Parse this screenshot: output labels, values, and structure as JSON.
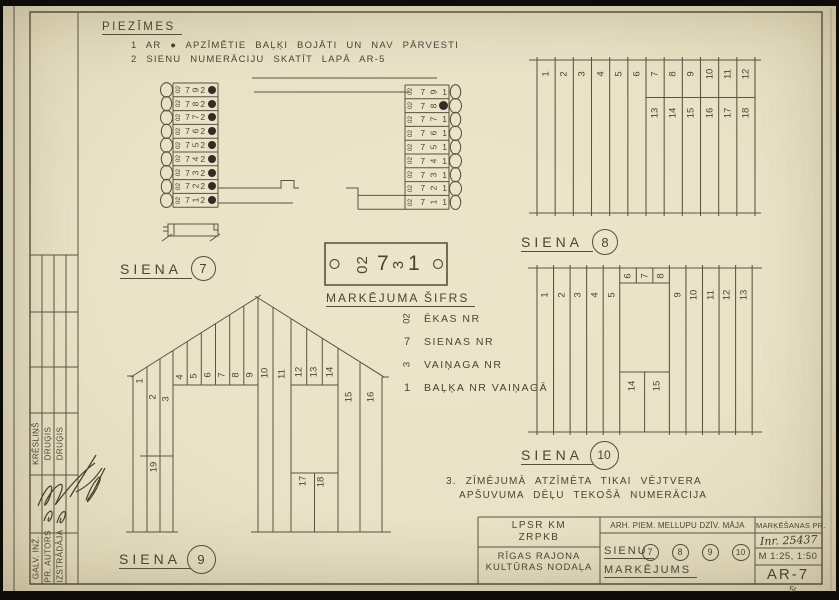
{
  "colors": {
    "paper": "#e9e2c6",
    "ink": "#4a4433",
    "damage_dot": "#322d24"
  },
  "corner_mark": "5r",
  "notes": {
    "title": "PIEZĪMES",
    "line1": "1 AR ● APZĪMĒTIE BAĻĶI BOJĀTI UN NAV PĀRVESTI",
    "line2": "2 SIENU NUMERĀCIJU SKATĪT LAPĀ AR-5",
    "note3_line1": "3. ZĪMĒJUMĀ ATZĪMĒTA TIKAI VĒJTVERA",
    "note3_line2": "APŠUVUMA DĒĻU TEKOŠĀ NUMERĀCIJA"
  },
  "siena7": {
    "label": "SIENA",
    "number": "7",
    "ekas_nr": "02",
    "sienas_nr": "7",
    "left_balkis": "2",
    "right_balkis": "1",
    "vainagi": [
      "9",
      "8",
      "7",
      "6",
      "5",
      "4",
      "3",
      "2",
      "1"
    ],
    "left_damaged": [
      true,
      true,
      true,
      true,
      true,
      true,
      true,
      true,
      true
    ],
    "right_damaged": [
      false,
      true,
      false,
      false,
      false,
      false,
      false,
      false,
      false
    ]
  },
  "stamp": {
    "code_ekas": "02",
    "code_siena": "7",
    "code_vainags": "3",
    "code_balkis": "1",
    "title": "MARKĒJUMA ŠIFRS",
    "legend": [
      {
        "key": "02",
        "label": "ĒKAS NR"
      },
      {
        "key": "7",
        "label": "SIENAS NR"
      },
      {
        "key": "3",
        "label": "VAIŅAGA NR"
      },
      {
        "key": "1",
        "label": "BAĻĶA NR VAIŅAGĀ"
      }
    ]
  },
  "siena8": {
    "label": "SIENA",
    "number": "8",
    "top_numbers": [
      "1",
      "2",
      "3",
      "4",
      "5",
      "6",
      "7",
      "8",
      "9",
      "10",
      "11",
      "12"
    ],
    "sub_numbers": [
      "13",
      "14",
      "15",
      "16",
      "17",
      "18"
    ]
  },
  "siena9": {
    "label": "SIENA",
    "number": "9",
    "numbers": [
      "1",
      "2",
      "3",
      "4",
      "5",
      "6",
      "7",
      "8",
      "9",
      "10",
      "11",
      "12",
      "13",
      "14",
      "15",
      "16",
      "17",
      "18",
      "19"
    ]
  },
  "siena10": {
    "label": "SIENA",
    "number": "10",
    "numbers_left": [
      "1",
      "2",
      "3",
      "4",
      "5"
    ],
    "numbers_top": [
      "6",
      "7",
      "8"
    ],
    "numbers_right": [
      "9",
      "10",
      "11",
      "12",
      "13"
    ],
    "numbers_bottom": [
      "14",
      "15"
    ]
  },
  "title_block": {
    "org_line1": "LPSR KM",
    "org_line2": "ZRPKB",
    "dept_line1": "RĪGAS RAJONA",
    "dept_line2": "KULTŪRAS NODAĻA",
    "project": "ARH. PIEM. MELLUPU DZĪV. MĀJA",
    "marking_header": "MARĶĒŠANAS PR.",
    "inventory_no": "Inr. 25437",
    "sheet_word": "SIENU",
    "wall_numbers": [
      "7",
      "8",
      "9",
      "10"
    ],
    "subject": "MARKĒJUMS",
    "scale": "M 1:25, 1:50",
    "code": "AR-7"
  },
  "signatures": {
    "rows": [
      {
        "role": "GALV. INŽ.",
        "name": "KRĒSLIŅŠ"
      },
      {
        "role": "PR. AUTORS",
        "name": "DRUĢIS"
      },
      {
        "role": "IZSTRĀDĀJA",
        "name": "DRUĢIS"
      }
    ]
  }
}
